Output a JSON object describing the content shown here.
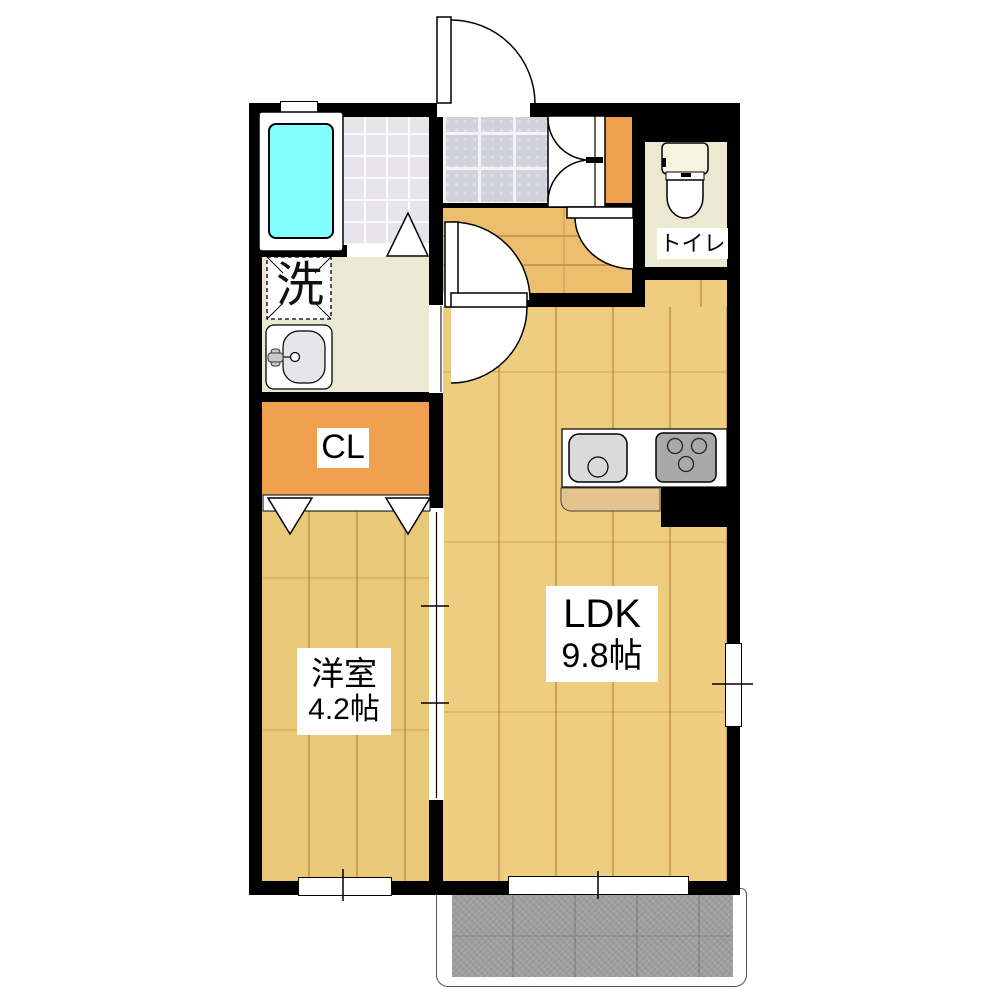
{
  "plan": {
    "type": "apartment-floor-plan",
    "rooms": {
      "ldk": {
        "label": "LDK",
        "area": "9.8帖"
      },
      "western_room": {
        "label": "洋室",
        "area": "4.2帖"
      },
      "closet": {
        "label": "CL"
      },
      "toilet": {
        "label": "トイレ"
      },
      "laundry": {
        "label": "洗"
      }
    },
    "colors": {
      "wall": "#000000",
      "ldk_floor": "#eecc80",
      "western_floor": "#eac87a",
      "hall_floor": "#ecbe6e",
      "closet_orange": "#f0a150",
      "bathtub": "#82ffff",
      "entrance_tile": "#d0d1da",
      "bath_tile": "#e7e5ea",
      "sanitary_floor": "#ece9d2",
      "balcony": "#9e9e9e"
    }
  }
}
